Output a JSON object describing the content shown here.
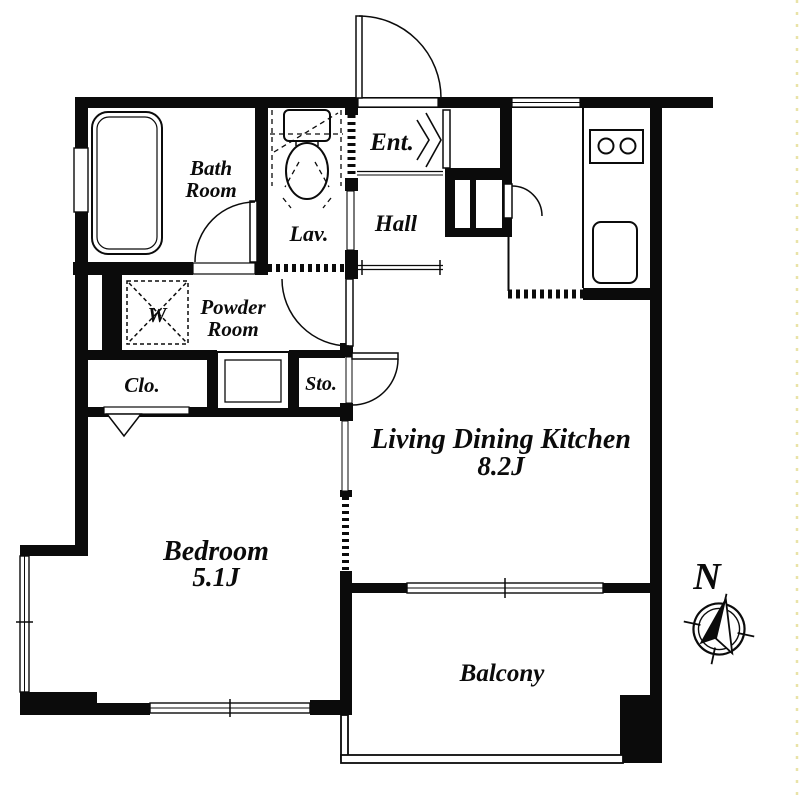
{
  "floorplan": {
    "rooms": {
      "bath": {
        "name_line1": "Bath",
        "name_line2": "Room"
      },
      "lavatory": {
        "name": "Lav."
      },
      "entrance": {
        "name": "Ent."
      },
      "hall": {
        "name": "Hall"
      },
      "powder": {
        "name_line1": "Powder",
        "name_line2": "Room"
      },
      "washer": {
        "symbol": "W"
      },
      "closet": {
        "name": "Clo."
      },
      "storage": {
        "name": "Sto."
      },
      "ldk": {
        "name": "Living Dining Kitchen",
        "area": "8.2J"
      },
      "bedroom": {
        "name": "Bedroom",
        "area": "5.1J"
      },
      "balcony": {
        "name": "Balcony"
      }
    },
    "compass": {
      "north_label": "N"
    },
    "colors": {
      "wall": "#0b0b0b",
      "background": "#ffffff",
      "edge_marker": "#e9e3a8"
    }
  }
}
